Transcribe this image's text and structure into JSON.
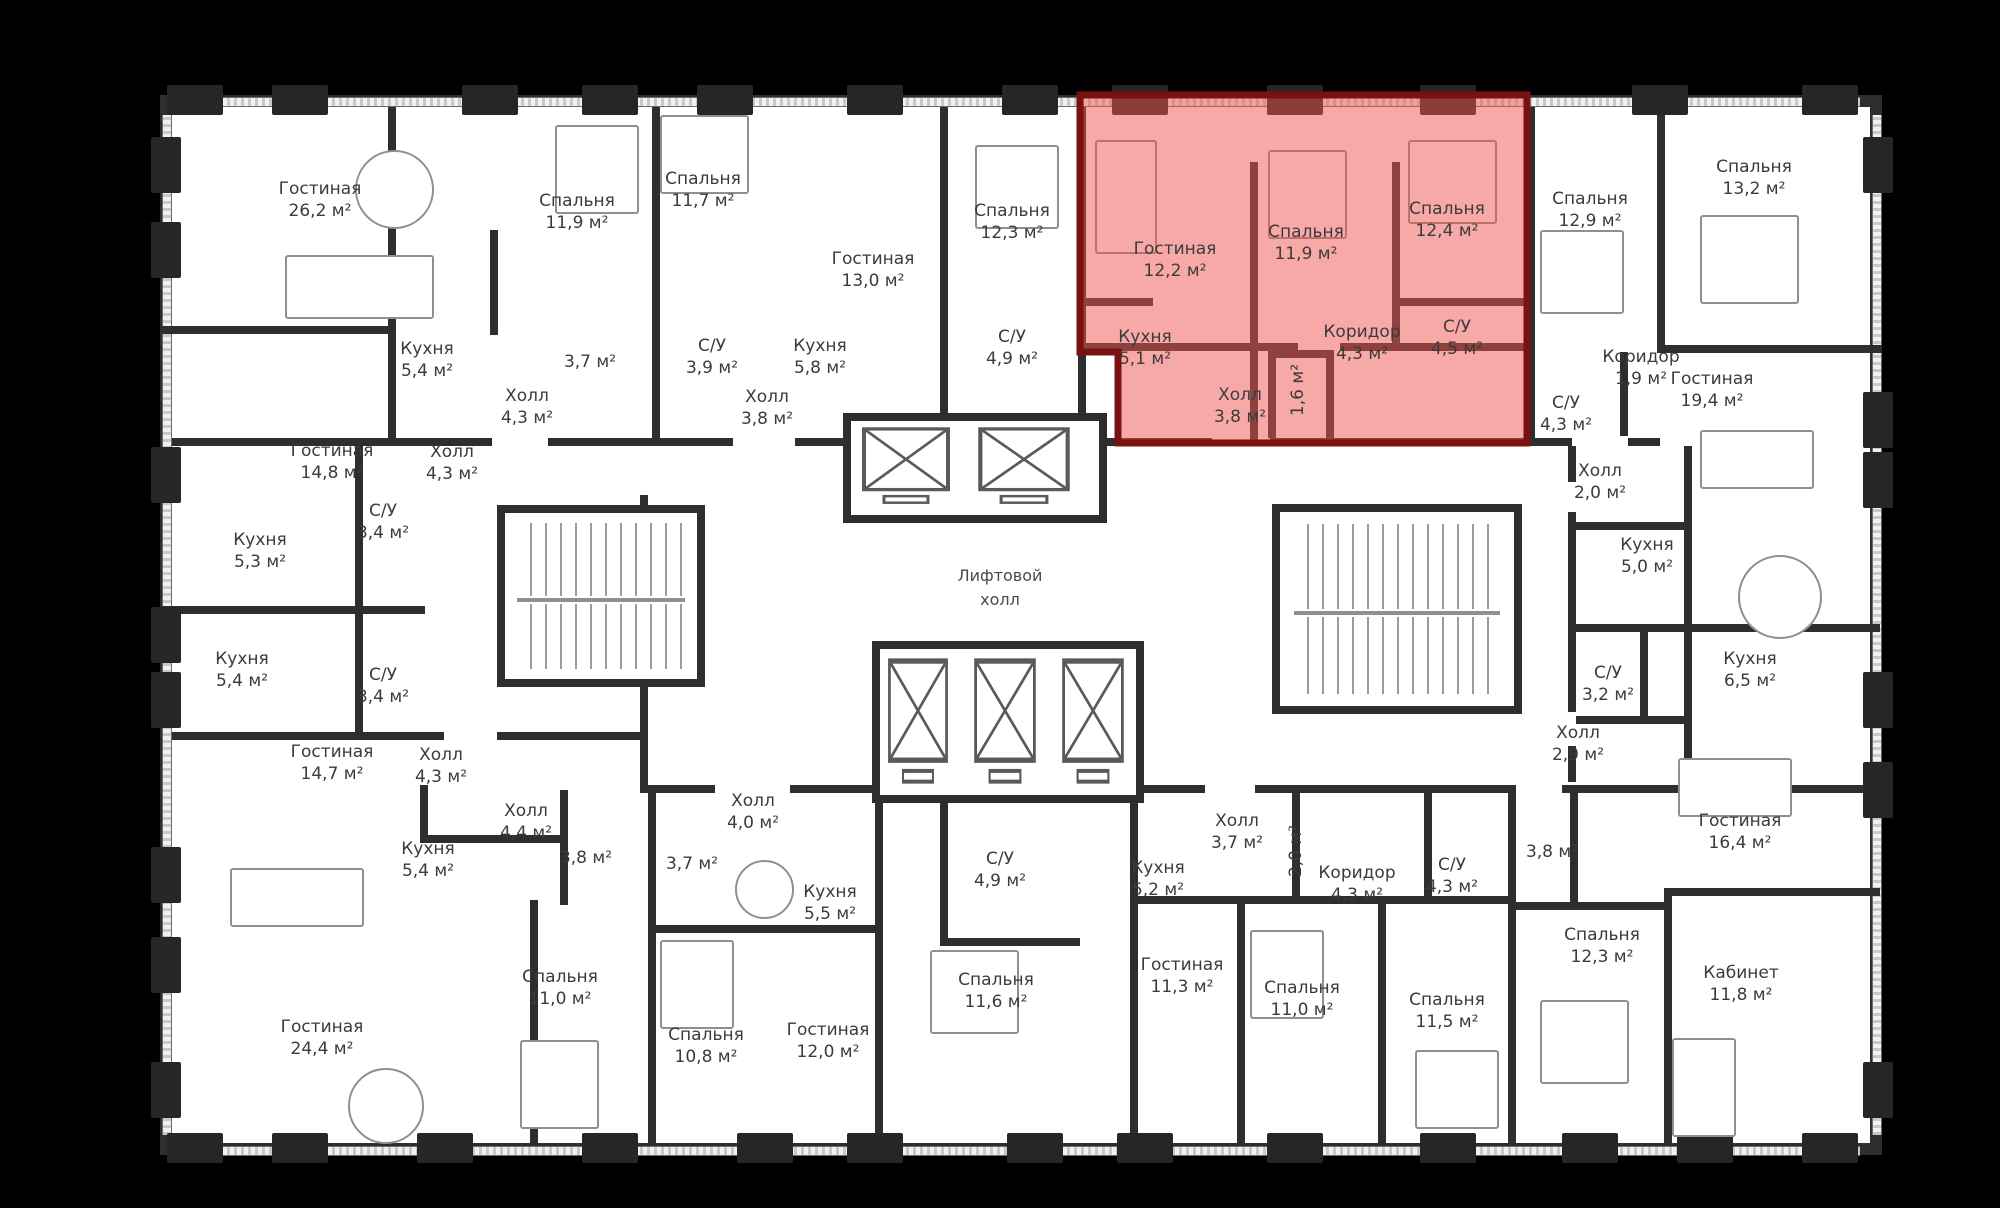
{
  "scene": {
    "background": "#000000",
    "plan_fill": "#ffffff",
    "wall_color": "#2e2e2e",
    "highlight_fill": "#ef5350",
    "highlight_stroke": "#7a1111",
    "label_color": "#3b3b3b"
  },
  "core": {
    "elevator_hall_line1": "Лифтовой",
    "elevator_hall_line2": "холл"
  },
  "rooms": [
    {
      "name": "Гостиная",
      "area": "26,2 м²",
      "x": 320,
      "y": 200,
      "red": false,
      "vertical": false
    },
    {
      "name": "Кухня",
      "area": "5,4 м²",
      "x": 427,
      "y": 360,
      "red": false,
      "vertical": false
    },
    {
      "name": "Спальня",
      "area": "11,9 м²",
      "x": 577,
      "y": 212,
      "red": false,
      "vertical": false
    },
    {
      "name": "",
      "area": "3,7 м²",
      "x": 590,
      "y": 362,
      "red": false,
      "vertical": false
    },
    {
      "name": "Холл",
      "area": "4,3 м²",
      "x": 527,
      "y": 407,
      "red": false,
      "vertical": false
    },
    {
      "name": "Спальня",
      "area": "11,7 м²",
      "x": 703,
      "y": 190,
      "red": false,
      "vertical": false
    },
    {
      "name": "С/У",
      "area": "3,9 м²",
      "x": 712,
      "y": 357,
      "red": false,
      "vertical": false
    },
    {
      "name": "Холл",
      "area": "3,8 м²",
      "x": 767,
      "y": 408,
      "red": false,
      "vertical": false
    },
    {
      "name": "Гостиная",
      "area": "13,0 м²",
      "x": 873,
      "y": 270,
      "red": false,
      "vertical": false
    },
    {
      "name": "Кухня",
      "area": "5,8 м²",
      "x": 820,
      "y": 357,
      "red": false,
      "vertical": false
    },
    {
      "name": "Спальня",
      "area": "12,3 м²",
      "x": 1012,
      "y": 222,
      "red": false,
      "vertical": false
    },
    {
      "name": "С/У",
      "area": "4,9 м²",
      "x": 1012,
      "y": 348,
      "red": false,
      "vertical": false
    },
    {
      "name": "Гостиная",
      "area": "12,2 м²",
      "x": 1175,
      "y": 260,
      "red": true,
      "vertical": false
    },
    {
      "name": "Спальня",
      "area": "11,9 м²",
      "x": 1306,
      "y": 243,
      "red": true,
      "vertical": false
    },
    {
      "name": "Спальня",
      "area": "12,4 м²",
      "x": 1447,
      "y": 220,
      "red": true,
      "vertical": false
    },
    {
      "name": "Кухня",
      "area": "5,1 м²",
      "x": 1145,
      "y": 348,
      "red": true,
      "vertical": false
    },
    {
      "name": "Коридор",
      "area": "4,3 м²",
      "x": 1362,
      "y": 343,
      "red": true,
      "vertical": false
    },
    {
      "name": "С/У",
      "area": "4,5 м²",
      "x": 1457,
      "y": 338,
      "red": true,
      "vertical": false
    },
    {
      "name": "Холл",
      "area": "3,8 м²",
      "x": 1240,
      "y": 406,
      "red": true,
      "vertical": false
    },
    {
      "name": "",
      "area": "1,6 м²",
      "x": 1298,
      "y": 390,
      "red": true,
      "vertical": true
    },
    {
      "name": "Спальня",
      "area": "12,9 м²",
      "x": 1590,
      "y": 210,
      "red": false,
      "vertical": false
    },
    {
      "name": "Спальня",
      "area": "13,2 м²",
      "x": 1754,
      "y": 178,
      "red": false,
      "vertical": false
    },
    {
      "name": "Коридор",
      "area": "1,9 м²",
      "x": 1641,
      "y": 368,
      "red": false,
      "vertical": false
    },
    {
      "name": "Гостиная",
      "area": "19,4 м²",
      "x": 1712,
      "y": 390,
      "red": false,
      "vertical": false
    },
    {
      "name": "С/У",
      "area": "4,3 м²",
      "x": 1566,
      "y": 414,
      "red": false,
      "vertical": false
    },
    {
      "name": "Гостиная",
      "area": "14,8 м²",
      "x": 332,
      "y": 462,
      "red": false,
      "vertical": false
    },
    {
      "name": "Холл",
      "area": "4,3 м²",
      "x": 452,
      "y": 463,
      "red": false,
      "vertical": false
    },
    {
      "name": "С/У",
      "area": "3,4 м²",
      "x": 383,
      "y": 522,
      "red": false,
      "vertical": false
    },
    {
      "name": "Кухня",
      "area": "5,3 м²",
      "x": 260,
      "y": 551,
      "red": false,
      "vertical": false
    },
    {
      "name": "Кухня",
      "area": "5,4 м²",
      "x": 242,
      "y": 670,
      "red": false,
      "vertical": false
    },
    {
      "name": "С/У",
      "area": "3,4 м²",
      "x": 383,
      "y": 686,
      "red": false,
      "vertical": false
    },
    {
      "name": "Холл",
      "area": "2,0 м²",
      "x": 1600,
      "y": 482,
      "red": false,
      "vertical": false
    },
    {
      "name": "Кухня",
      "area": "5,0 м²",
      "x": 1647,
      "y": 556,
      "red": false,
      "vertical": false
    },
    {
      "name": "С/У",
      "area": "3,2 м²",
      "x": 1608,
      "y": 684,
      "red": false,
      "vertical": false
    },
    {
      "name": "Холл",
      "area": "2,9 м²",
      "x": 1578,
      "y": 744,
      "red": false,
      "vertical": false
    },
    {
      "name": "Кухня",
      "area": "6,5 м²",
      "x": 1750,
      "y": 670,
      "red": false,
      "vertical": false
    },
    {
      "name": "Гостиная",
      "area": "14,7 м²",
      "x": 332,
      "y": 763,
      "red": false,
      "vertical": false
    },
    {
      "name": "Холл",
      "area": "4,3 м²",
      "x": 441,
      "y": 766,
      "red": false,
      "vertical": false
    },
    {
      "name": "Холл",
      "area": "4,4 м²",
      "x": 526,
      "y": 822,
      "red": false,
      "vertical": false
    },
    {
      "name": "Кухня",
      "area": "5,4 м²",
      "x": 428,
      "y": 860,
      "red": false,
      "vertical": false
    },
    {
      "name": "",
      "area": "3,8 м²",
      "x": 586,
      "y": 858,
      "red": false,
      "vertical": false
    },
    {
      "name": "Гостиная",
      "area": "24,4 м²",
      "x": 322,
      "y": 1038,
      "red": false,
      "vertical": false
    },
    {
      "name": "Спальня",
      "area": "11,0 м²",
      "x": 560,
      "y": 988,
      "red": false,
      "vertical": false
    },
    {
      "name": "Холл",
      "area": "4,0 м²",
      "x": 753,
      "y": 812,
      "red": false,
      "vertical": false
    },
    {
      "name": "",
      "area": "3,7 м²",
      "x": 692,
      "y": 864,
      "red": false,
      "vertical": false
    },
    {
      "name": "Кухня",
      "area": "5,5 м²",
      "x": 830,
      "y": 903,
      "red": false,
      "vertical": false
    },
    {
      "name": "Спальня",
      "area": "10,8 м²",
      "x": 706,
      "y": 1046,
      "red": false,
      "vertical": false
    },
    {
      "name": "Гостиная",
      "area": "12,0 м²",
      "x": 828,
      "y": 1041,
      "red": false,
      "vertical": false
    },
    {
      "name": "С/У",
      "area": "4,9 м²",
      "x": 1000,
      "y": 870,
      "red": false,
      "vertical": false
    },
    {
      "name": "Спальня",
      "area": "11,6 м²",
      "x": 996,
      "y": 991,
      "red": false,
      "vertical": false
    },
    {
      "name": "Кухня",
      "area": "5,2 м²",
      "x": 1158,
      "y": 879,
      "red": false,
      "vertical": false
    },
    {
      "name": "Гостиная",
      "area": "11,3 м²",
      "x": 1182,
      "y": 976,
      "red": false,
      "vertical": false
    },
    {
      "name": "Холл",
      "area": "3,7 м²",
      "x": 1237,
      "y": 832,
      "red": false,
      "vertical": false
    },
    {
      "name": "",
      "area": "2,0 м²",
      "x": 1296,
      "y": 851,
      "red": false,
      "vertical": true
    },
    {
      "name": "Коридор",
      "area": "4,3 м²",
      "x": 1357,
      "y": 884,
      "red": false,
      "vertical": false
    },
    {
      "name": "С/У",
      "area": "4,3 м²",
      "x": 1452,
      "y": 876,
      "red": false,
      "vertical": false
    },
    {
      "name": "",
      "area": "3,8 м²",
      "x": 1552,
      "y": 852,
      "red": false,
      "vertical": false
    },
    {
      "name": "Спальня",
      "area": "11,0 м²",
      "x": 1302,
      "y": 999,
      "red": false,
      "vertical": false
    },
    {
      "name": "Спальня",
      "area": "11,5 м²",
      "x": 1447,
      "y": 1011,
      "red": false,
      "vertical": false
    },
    {
      "name": "Спальня",
      "area": "12,3 м²",
      "x": 1602,
      "y": 946,
      "red": false,
      "vertical": false
    },
    {
      "name": "Гостиная",
      "area": "16,4 м²",
      "x": 1740,
      "y": 832,
      "red": false,
      "vertical": false
    },
    {
      "name": "Кабинет",
      "area": "11,8 м²",
      "x": 1741,
      "y": 984,
      "red": false,
      "vertical": false
    }
  ]
}
